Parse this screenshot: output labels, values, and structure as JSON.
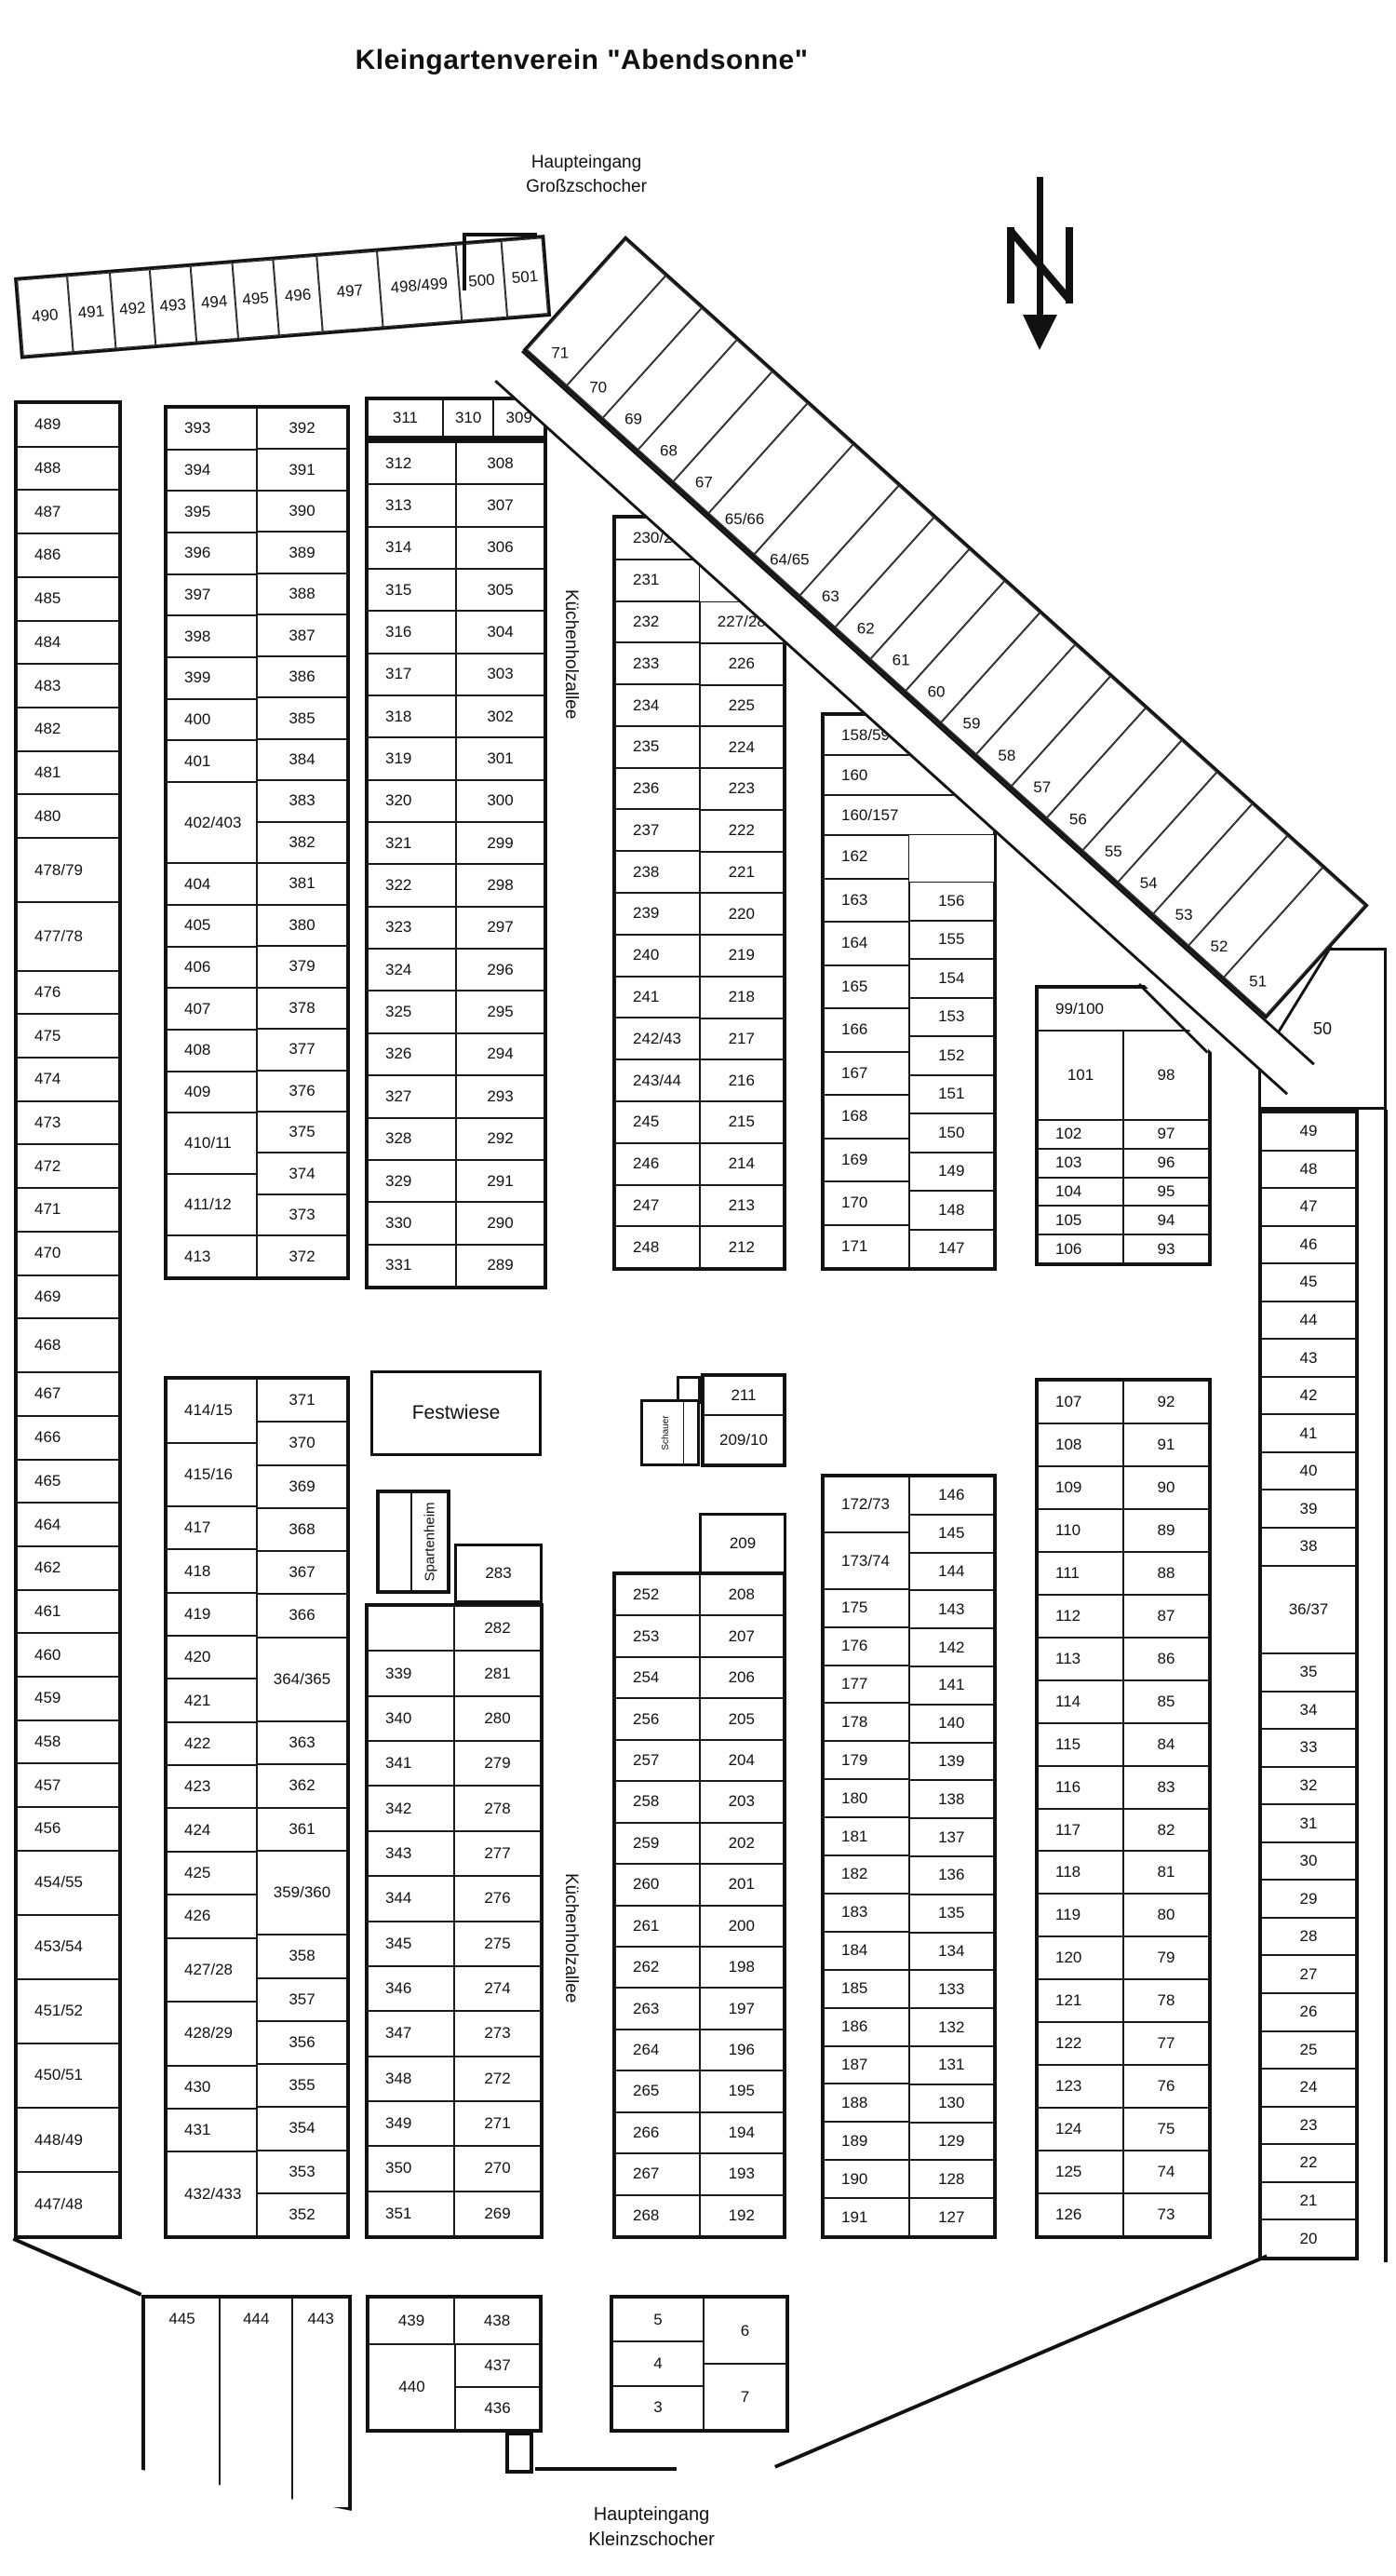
{
  "title": "Kleingartenverein \"Abendsonne\"",
  "entrance_top": {
    "line1": "Haupteingang",
    "line2": "Großzschocher"
  },
  "entrance_bottom": {
    "line1": "Haupteingang",
    "line2": "Kleinzschocher"
  },
  "street_name": "Küchenholzallee",
  "areas": {
    "festwiese": "Festwiese",
    "spartenheim": "Spartenheim",
    "schauer": "Schauer"
  },
  "north_label": "N",
  "plots": {
    "top_strip": [
      "490",
      "491",
      "492",
      "493",
      "494",
      "495",
      "496",
      "497",
      "498/499",
      "500",
      "501"
    ],
    "col_a": [
      "489",
      "488",
      "487",
      "486",
      "485",
      "484",
      "483",
      "482",
      "481",
      "480",
      "478/79",
      "477/78",
      "476",
      "475",
      "474",
      "473",
      "472",
      "471",
      "470",
      "469",
      "468",
      "467",
      "466",
      "465",
      "464",
      "462",
      "461",
      "460",
      "459",
      "458",
      "457",
      "456",
      "454/55",
      "453/54",
      "451/52",
      "450/51",
      "448/49",
      "447/48"
    ],
    "col_b_upper_left": [
      "393",
      "394",
      "395",
      "396",
      "397",
      "398",
      "399",
      "400",
      "401",
      "402/403",
      "404",
      "405",
      "406",
      "407",
      "408",
      "409",
      "410/11",
      "411/12",
      "413"
    ],
    "col_b_upper_right": [
      "392",
      "391",
      "390",
      "389",
      "388",
      "387",
      "386",
      "385",
      "384",
      "383",
      "382",
      "381",
      "380",
      "379",
      "378",
      "377",
      "376",
      "375",
      "374",
      "373",
      "372"
    ],
    "col_b_lower_left": [
      "414/15",
      "415/16",
      "417",
      "418",
      "419",
      "420",
      "421",
      "422",
      "423",
      "424",
      "425",
      "426",
      "427/28",
      "428/29",
      "430",
      "431",
      "432/433"
    ],
    "col_b_lower_right": [
      "371",
      "370",
      "369",
      "368",
      "367",
      "366",
      "364/365",
      "363",
      "362",
      "361",
      "359/360",
      "358",
      "357",
      "356",
      "355",
      "354",
      "353",
      "352"
    ],
    "col_c_top_row": [
      "311",
      "310",
      "309"
    ],
    "col_c_upper_left": [
      "312",
      "313",
      "314",
      "315",
      "316",
      "317",
      "318",
      "319",
      "320",
      "321",
      "322",
      "323",
      "324",
      "325",
      "326",
      "327",
      "328",
      "329",
      "330",
      "331"
    ],
    "col_c_upper_right": [
      "308",
      "307",
      "306",
      "305",
      "304",
      "303",
      "302",
      "301",
      "300",
      "299",
      "298",
      "297",
      "296",
      "295",
      "294",
      "293",
      "292",
      "291",
      "290",
      "289"
    ],
    "col_c_lower_left": [
      "",
      "339",
      "340",
      "341",
      "342",
      "343",
      "344",
      "345",
      "346",
      "347",
      "348",
      "349",
      "350",
      "351"
    ],
    "col_c_lower_right": [
      "282",
      "281",
      "280",
      "279",
      "278",
      "277",
      "276",
      "275",
      "274",
      "273",
      "272",
      "271",
      "270",
      "269"
    ],
    "box_283": "283",
    "schauer_block": [
      "211",
      "209/10"
    ],
    "col_d_upper_left": [
      "230/29",
      "231",
      "232",
      "233",
      "234",
      "235",
      "236",
      "237",
      "238",
      "239",
      "240",
      "241",
      "242/43",
      "243/44",
      "245",
      "246",
      "247",
      "248"
    ],
    "col_d_upper_right": [
      "227/28",
      "226",
      "225",
      "224",
      "223",
      "222",
      "221",
      "220",
      "219",
      "218",
      "217",
      "216",
      "215",
      "214",
      "213",
      "212"
    ],
    "col_d_209": "209",
    "col_d_lower_left": [
      "252",
      "253",
      "254",
      "256",
      "257",
      "258",
      "259",
      "260",
      "261",
      "262",
      "263",
      "264",
      "265",
      "266",
      "267",
      "268"
    ],
    "col_d_lower_right": [
      "208",
      "207",
      "206",
      "205",
      "204",
      "203",
      "202",
      "201",
      "200",
      "198",
      "197",
      "196",
      "195",
      "194",
      "193",
      "192"
    ],
    "col_e_upper_full": [
      "158/59",
      "160",
      "160/157"
    ],
    "col_e_upper_left": [
      "162",
      "163",
      "164",
      "165",
      "166",
      "167",
      "168",
      "169",
      "170",
      "171"
    ],
    "col_e_upper_right": [
      "156",
      "155",
      "154",
      "153",
      "152",
      "151",
      "150",
      "149",
      "148",
      "147"
    ],
    "col_e_lower_left": [
      "172/73",
      "173/74",
      "175",
      "176",
      "177",
      "178",
      "179",
      "180",
      "181",
      "182",
      "183",
      "184",
      "185",
      "186",
      "187",
      "188",
      "189",
      "190",
      "191"
    ],
    "col_e_lower_right": [
      "146",
      "145",
      "144",
      "143",
      "142",
      "141",
      "140",
      "139",
      "138",
      "137",
      "136",
      "135",
      "134",
      "133",
      "132",
      "131",
      "130",
      "129",
      "128",
      "127"
    ],
    "col_f_top": "99/100",
    "col_f_row2": [
      "101",
      "98"
    ],
    "col_f_upper_left": [
      "102",
      "103",
      "104",
      "105",
      "106"
    ],
    "col_f_upper_right": [
      "97",
      "96",
      "95",
      "94",
      "93"
    ],
    "col_f_lower_left": [
      "107",
      "108",
      "109",
      "110",
      "111",
      "112",
      "113",
      "114",
      "115",
      "116",
      "117",
      "118",
      "119",
      "120",
      "121",
      "122",
      "123",
      "124",
      "125",
      "126"
    ],
    "col_f_lower_right": [
      "92",
      "91",
      "90",
      "89",
      "88",
      "87",
      "86",
      "85",
      "84",
      "83",
      "82",
      "81",
      "80",
      "79",
      "78",
      "77",
      "76",
      "75",
      "74",
      "73"
    ],
    "plot_50": "50",
    "right_col": [
      "49",
      "48",
      "47",
      "46",
      "45",
      "44",
      "43",
      "42",
      "41",
      "40",
      "39",
      "38",
      "36/37",
      "35",
      "34",
      "33",
      "32",
      "31",
      "30",
      "29",
      "28",
      "27",
      "26",
      "25",
      "24",
      "23",
      "22",
      "21",
      "20"
    ],
    "diagonal": [
      "71",
      "70",
      "69",
      "68",
      "67",
      "65/66",
      "64/65",
      "63",
      "62",
      "61",
      "60",
      "59",
      "58",
      "57",
      "56",
      "55",
      "54",
      "53",
      "52",
      "51"
    ],
    "bottom_a": [
      "445",
      "444",
      "443"
    ],
    "bottom_b_row": [
      "439",
      "438"
    ],
    "bottom_b_left": "440",
    "bottom_b_right": [
      "437",
      "436"
    ],
    "bottom_c_left": [
      "5",
      "4",
      "3"
    ],
    "bottom_c_right": [
      "6",
      "7"
    ]
  }
}
